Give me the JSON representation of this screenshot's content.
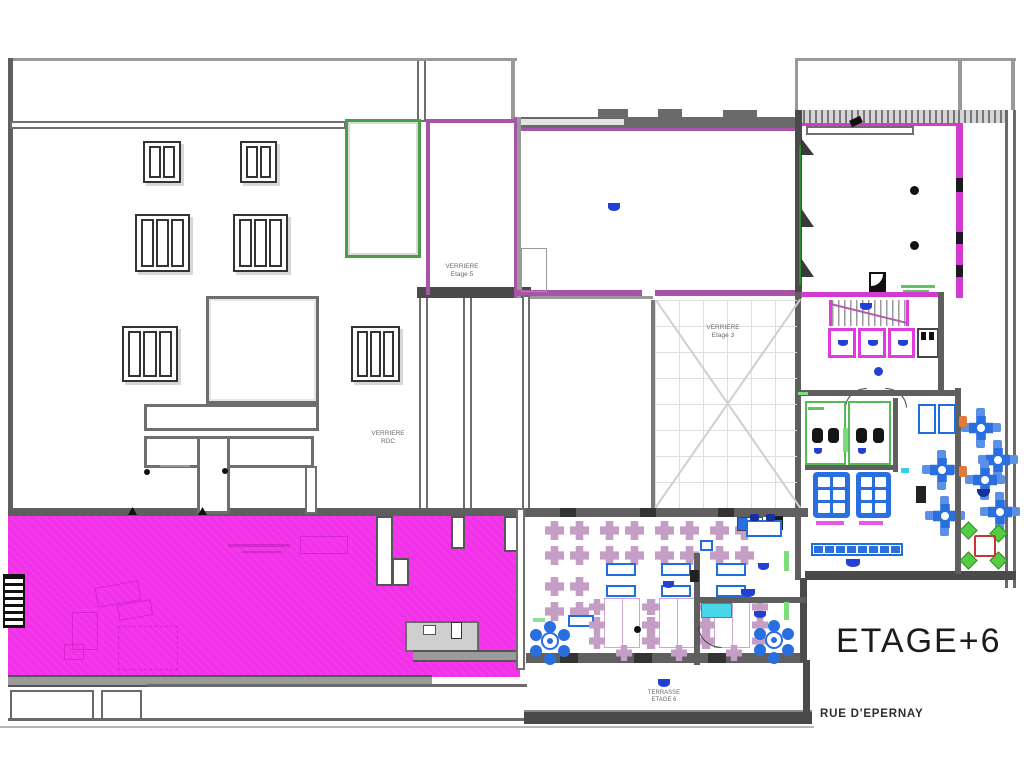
{
  "drawing": {
    "floor_title": "ETAGE+6",
    "street_name": "RUE D'EPERNAY",
    "annotations": {
      "verriere_etage5": {
        "line1": "VERRIERE",
        "line2": "Etage 5"
      },
      "verriere_rdc": {
        "line1": "VERRIERE",
        "line2": "RDC"
      },
      "verriere_etage3": {
        "line1": "VERRIERE",
        "line2": "Etage 3"
      },
      "terrasse_etage6": {
        "line1": "TERRASSE",
        "line2": "ETAGE 6"
      }
    },
    "colors": {
      "terrace_fill_magenta": "#F231E8",
      "wall_gray": "#5F5F5F",
      "room_outline_purple": "#A855A8",
      "elevator_magenta": "#E03AE0",
      "furniture_blue": "#2A6FE0",
      "marker_blue": "#2340D6",
      "chair_mauve": "#C49EC4",
      "green_outline": "#4A9D4A",
      "chair_green": "#55CC44",
      "table_red_outline": "#CC3333",
      "accent_orange": "#E07B39",
      "cyan_counter": "#49D6E8"
    },
    "icons": {
      "door_marker": "half-disc-blue",
      "column_marker": "black-dot"
    }
  }
}
